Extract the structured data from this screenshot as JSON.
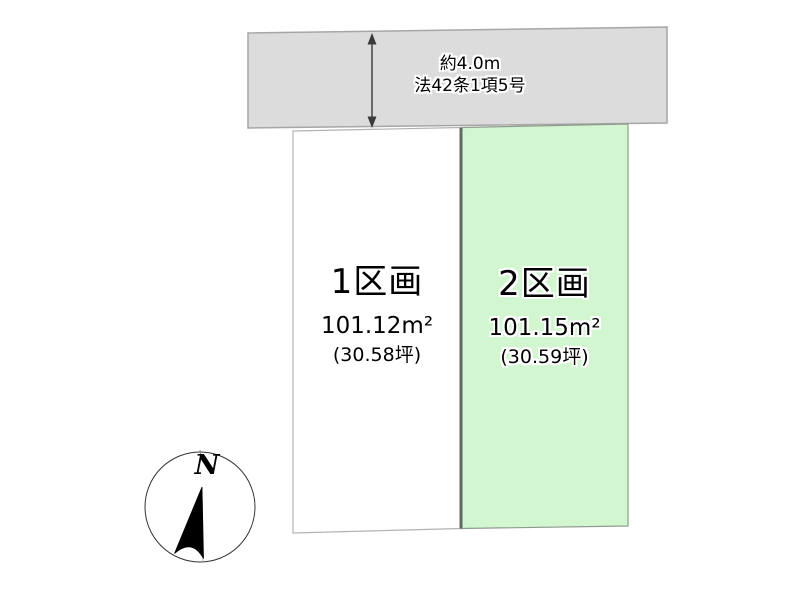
{
  "road": {
    "width_label": "約4.0m",
    "law_label": "法42条1項5号",
    "fill": "#dcdcdc",
    "border": "#a6a6a6"
  },
  "width_arrow": {
    "color": "#3a3a3a"
  },
  "plots": [
    {
      "name": "1区画",
      "area": "101.12m²",
      "tsubo": "(30.58坪)",
      "fill": "#ffffff",
      "border": "#b3b3b3"
    },
    {
      "name": "2区画",
      "area": "101.15m²",
      "tsubo": "(30.59坪)",
      "fill": "#d2f7d0",
      "border": "#8f9b8f"
    }
  ],
  "divider_color": "#5f6b5f",
  "compass": {
    "label": "N",
    "circle_color": "#333333",
    "needle_color": "#000000"
  }
}
